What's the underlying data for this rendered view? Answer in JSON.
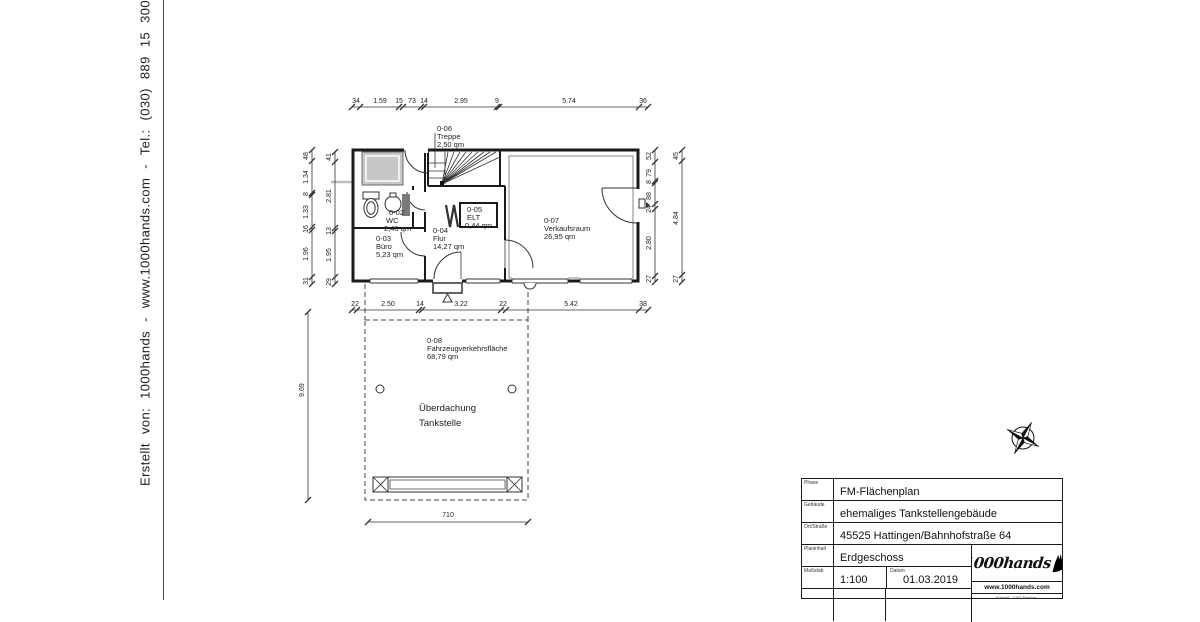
{
  "margin": {
    "credit": "Erstellt von:  1000hands  -  www.1000hands.com  -  Tel.: (030)  889 15 300"
  },
  "plan": {
    "rooms": [
      {
        "id": "0-02",
        "name": "WC",
        "area": "2,46 qm"
      },
      {
        "id": "0-03",
        "name": "Büro",
        "area": "5,23 qm"
      },
      {
        "id": "0-04",
        "name": "Flur",
        "area": "14,27 qm"
      },
      {
        "id": "0-05",
        "name": "ELT",
        "area": "0,44 qm"
      },
      {
        "id": "0-06",
        "name": "Treppe",
        "area": "2,50 qm"
      },
      {
        "id": "0-07",
        "name": "Verkaufsraum",
        "area": "26,95 qm"
      },
      {
        "id": "0-08",
        "name": "Fahrzeugverkehrsfläche",
        "area": "68,79 qm"
      }
    ],
    "canopy": {
      "line1": "Überdachung",
      "line2": "Tankstelle"
    },
    "dims": {
      "top": [
        "34",
        "1.59",
        "15",
        "73",
        "14",
        "2.95",
        "9",
        "5.74",
        "36"
      ],
      "bottom": [
        "22",
        "2.50",
        "14",
        "3.22",
        "22",
        "5.42",
        "38"
      ],
      "left_outer": [
        "48",
        "1.34",
        "8",
        "1.33",
        "16",
        "1.96",
        "31"
      ],
      "left_inner": [
        "41",
        "2.81",
        "13",
        "1.95",
        "29"
      ],
      "right_inner": [
        "52",
        "79",
        "8",
        "88",
        "24",
        "2.80",
        "27"
      ],
      "right_outer": [
        "45",
        "4.84",
        "27"
      ],
      "canopy_width": "710",
      "canopy_depth": "9.69"
    }
  },
  "titleblock": {
    "rows": [
      {
        "label": "Phase",
        "value": "FM-Flächenplan"
      },
      {
        "label": "Gebäude",
        "value": "ehemaliges Tankstellengebäude"
      },
      {
        "label": "Ort/Straße",
        "value": "45525 Hattingen/Bahnhofstraße 64"
      },
      {
        "label": "Planinhalt",
        "value": "Erdgeschoss"
      },
      {
        "label": "Maßstab",
        "value": "1:100"
      },
      {
        "label": "Datum",
        "value": "01.03.2019"
      }
    ],
    "logo": {
      "brand": "1000hands",
      "site": "www.1000hands.com",
      "tagline": "Aufmaß - CAD-Service -"
    }
  }
}
